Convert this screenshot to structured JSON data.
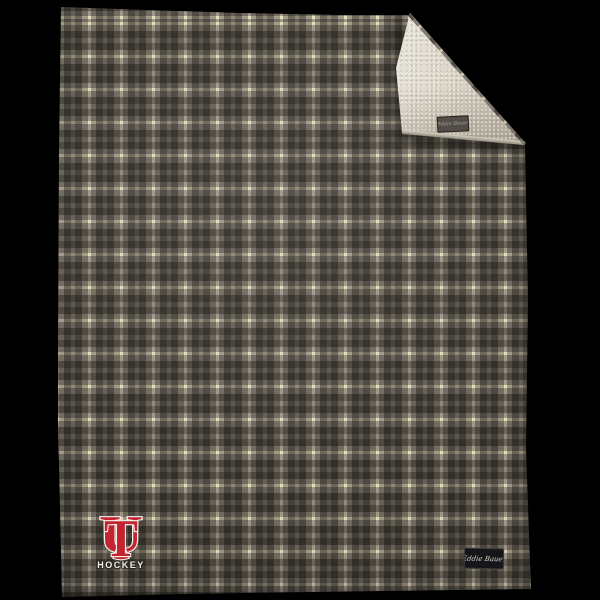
{
  "scene": {
    "background_color": "#000000",
    "subject": "plaid fleece blanket with folded corner showing sherpa lining"
  },
  "blanket": {
    "plaid": {
      "ground_color": "#706b61",
      "dark_stripe_color": "#332f29",
      "cream_stripe_color": "#e5dab8",
      "repeat_px": 32
    },
    "sherpa": {
      "color": "#dcd6c8"
    },
    "flap_tag": {
      "label": "Eddie Bauer",
      "fabric_color": "#514d47",
      "text_color": "#a8a49c"
    },
    "brand_tag": {
      "label": "Eddie Bauer",
      "fabric_color": "#16161a",
      "text_color": "#d8d4c8"
    }
  },
  "logo": {
    "monogram_u": "U",
    "monogram_t": "T",
    "monogram_color": "#c42430",
    "monogram_outline": "#f4f2ec",
    "wordmark": "HOCKEY",
    "wordmark_color": "#f2efe8"
  }
}
